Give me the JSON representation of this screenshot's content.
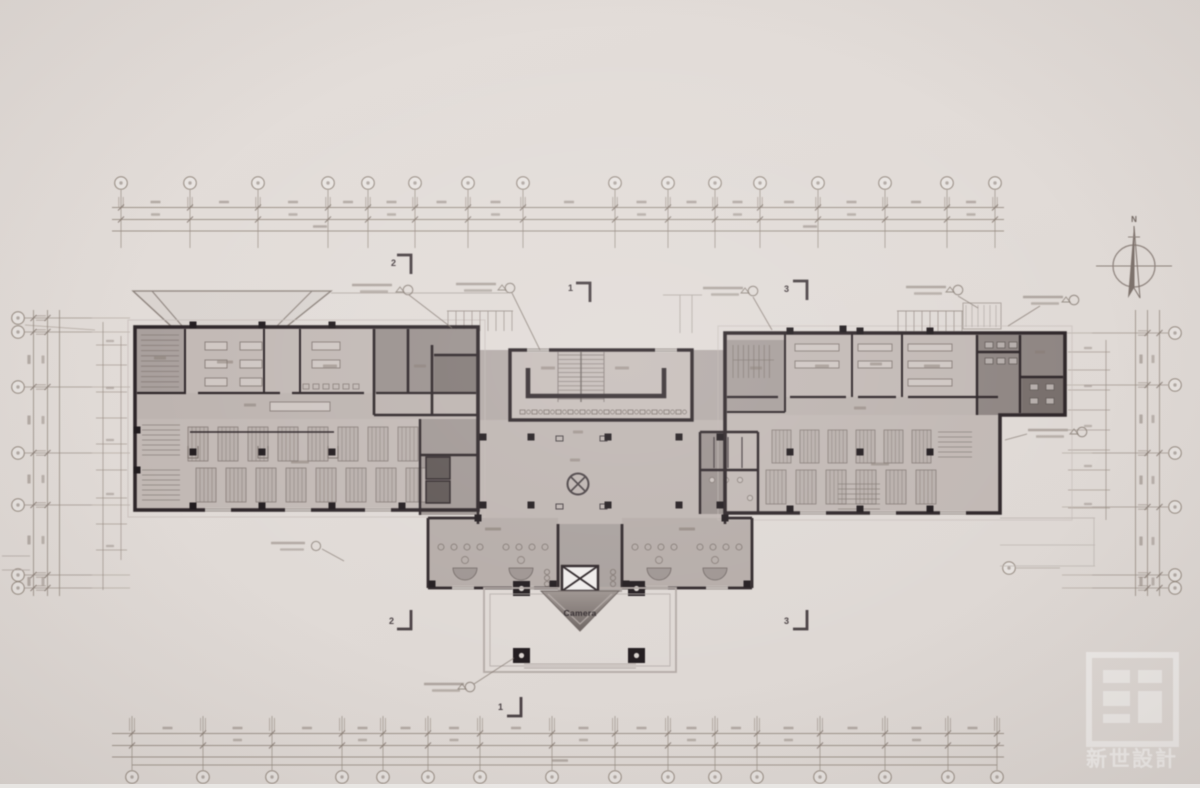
{
  "drawing": {
    "type": "architectural-floor-plan",
    "entrance_label": "Camera",
    "compass_label": "N",
    "watermark_text": "新世設計",
    "section_markers": {
      "one": "1",
      "two": "2",
      "three": "3"
    }
  },
  "colors": {
    "background": "#e1dbd7",
    "dim_line": "#94897f",
    "smudge": "#857a72",
    "wall": "#2e2629",
    "wall_medium": "#4a4144",
    "fill_light": "#c8c0bc",
    "fill_room": "#c2b9b5",
    "fill_corridor": "#bdb4b0",
    "fill_core": "#a19895",
    "fill_dark": "#8e8582",
    "fill_darker": "#776e6b",
    "furniture": "#7e746f",
    "column": "#221c1f",
    "porch_line": "#b3aaa6",
    "canopy_line": "#8d837d",
    "watermark": "rgba(255,255,255,0.48)",
    "label_dark": "#332c2f"
  }
}
